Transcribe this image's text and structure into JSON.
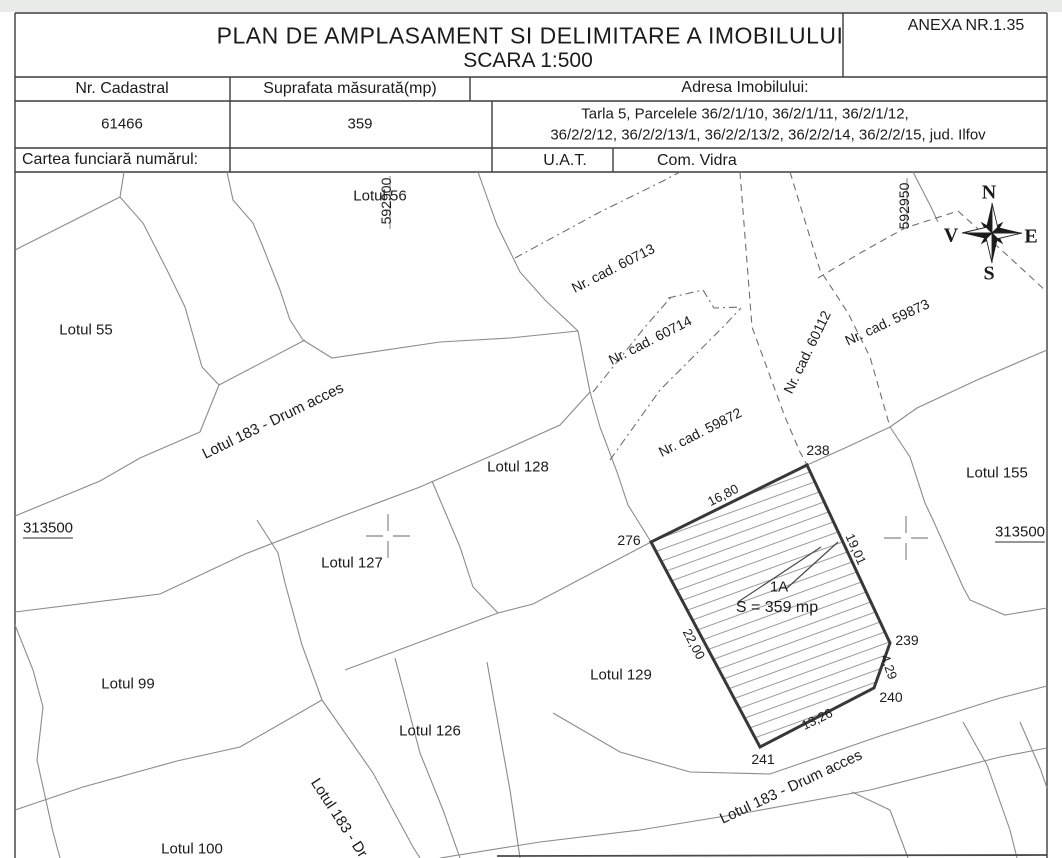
{
  "header": {
    "anexa": "ANEXA NR.1.35",
    "title": "PLAN DE AMPLASAMENT SI DELIMITARE A IMOBILULUI",
    "subtitle": "SCARA 1:500"
  },
  "table": {
    "col_nr_cadastral": "Nr. Cadastral",
    "col_suprafata": "Suprafata măsurată(mp)",
    "col_adresa": "Adresa Imobilului:",
    "nr_cadastral": "61466",
    "suprafata": "359",
    "adresa_line1": "Tarla 5, Parcelele 36/2/1/10, 36/2/1/11, 36/2/1/12,",
    "adresa_line2": "36/2/2/12, 36/2/2/13/1, 36/2/2/13/2, 36/2/2/14, 36/2/2/15, jud. Ilfov",
    "cartea_funciara": "Cartea funciară numărul:",
    "uat_label": "U.A.T.",
    "uat_value": "Com. Vidra"
  },
  "map": {
    "grid_x": [
      {
        "label": "592900"
      },
      {
        "label": "592950"
      }
    ],
    "grid_y": [
      {
        "label": "313500"
      },
      {
        "label": "313500"
      }
    ],
    "compass": {
      "n": "N",
      "e": "E",
      "s": "S",
      "w": "V"
    },
    "lots": [
      {
        "label": "Lotul 56"
      },
      {
        "label": "Lotul 55"
      },
      {
        "label": "Lotul 128"
      },
      {
        "label": "Lotul 127"
      },
      {
        "label": "Lotul 155"
      },
      {
        "label": "Lotul 99"
      },
      {
        "label": "Lotul 129"
      },
      {
        "label": "Lotul 126"
      },
      {
        "label": "Lotul 100"
      }
    ],
    "roads": [
      {
        "label": "Lotul 183 - Drum acces"
      },
      {
        "label": "Lotul 183 - Dr"
      },
      {
        "label": "Lotul 183 - Drum acces"
      }
    ],
    "cadastral": [
      {
        "label": "Nr. cad. 60713"
      },
      {
        "label": "Nr. cad. 60714"
      },
      {
        "label": "Nr. cad. 59872"
      },
      {
        "label": "Nr. cad. 60112"
      },
      {
        "label": "Nr. cad. 59873"
      }
    ],
    "parcel": {
      "name": "1A",
      "area": "S = 359 mp",
      "points": [
        {
          "id": "238"
        },
        {
          "id": "239"
        },
        {
          "id": "240"
        },
        {
          "id": "241"
        },
        {
          "id": "276"
        }
      ],
      "dims": [
        {
          "value": "16,80"
        },
        {
          "value": "19,01"
        },
        {
          "value": "22,00"
        },
        {
          "value": "4,29"
        },
        {
          "value": "13,26"
        }
      ]
    }
  }
}
